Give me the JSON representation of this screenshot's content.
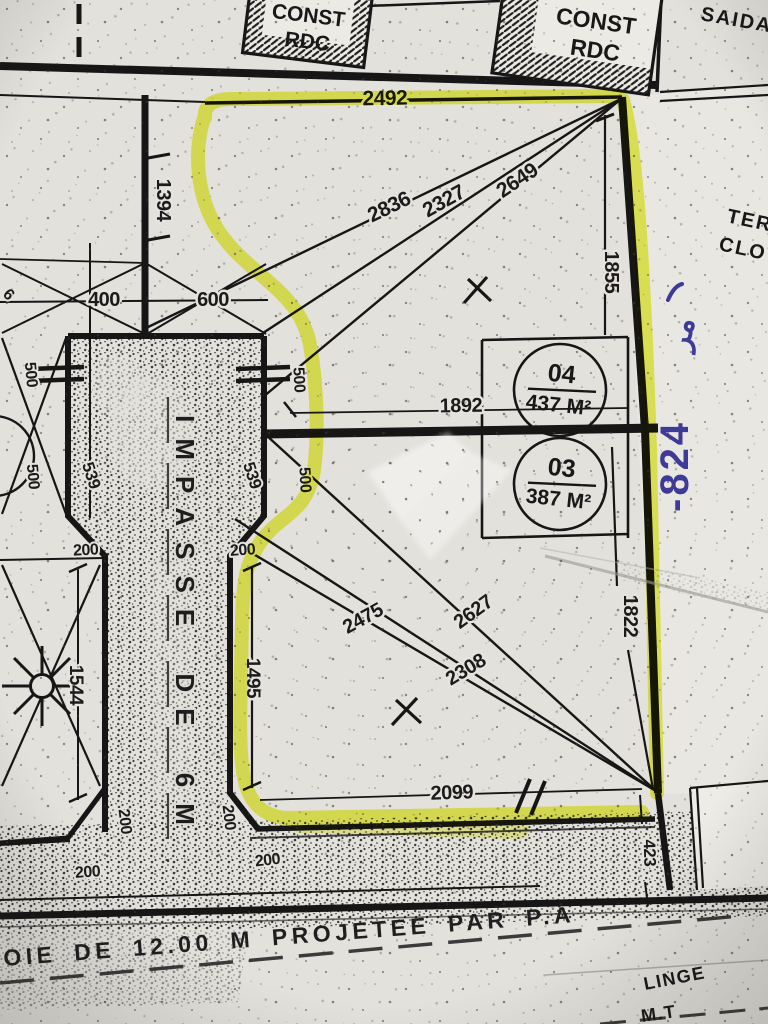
{
  "plan": {
    "title_boxes": {
      "const_line1": "CONST",
      "const_line2": "RDC"
    },
    "corner_text": "SAIDAI",
    "side_texts": {
      "ter": "TER",
      "clot": "CLOT"
    },
    "parcels": {
      "p04": {
        "num": "04",
        "area": "437 M²"
      },
      "p03": {
        "num": "03",
        "area": "387 M²"
      }
    },
    "impasse_label": "IMPASSE DE 6M",
    "road_label": "OIE DE 12.00 M PROJETEE PAR P.A",
    "power_line": {
      "l1": "LINGE",
      "l2": "M.T"
    },
    "handwriting": {
      "digits": "-824",
      "letters": "مر"
    },
    "colors": {
      "highlighter": "#e9f237",
      "ink_blue": "#3e3a97",
      "paper": "#e3e1dc",
      "line": "#161616"
    },
    "dims": {
      "top": "2492",
      "left_upper": "1394",
      "diag_a": "2836",
      "diag_b": "2327",
      "diag_c": "2649",
      "right_upper": "1855",
      "w_left": "400",
      "w_right": "600",
      "mid_width": "1892",
      "s500_a": "500",
      "s500_b": "500",
      "s500_c": "500",
      "s500_d": "500",
      "s539_l": "539",
      "s539_r": "539",
      "left_lower": "1544",
      "inner_lower": "1495",
      "diag_d": "2475",
      "diag_e": "2627",
      "diag_f": "2308",
      "bottom": "2099",
      "right_lower": "1822",
      "right_end": "423",
      "n200_a": "200",
      "n200_b": "200",
      "n200_c": "200",
      "n200_d": "200",
      "n200_e": "200",
      "n200_f": "200",
      "edge_partial": "6"
    }
  }
}
